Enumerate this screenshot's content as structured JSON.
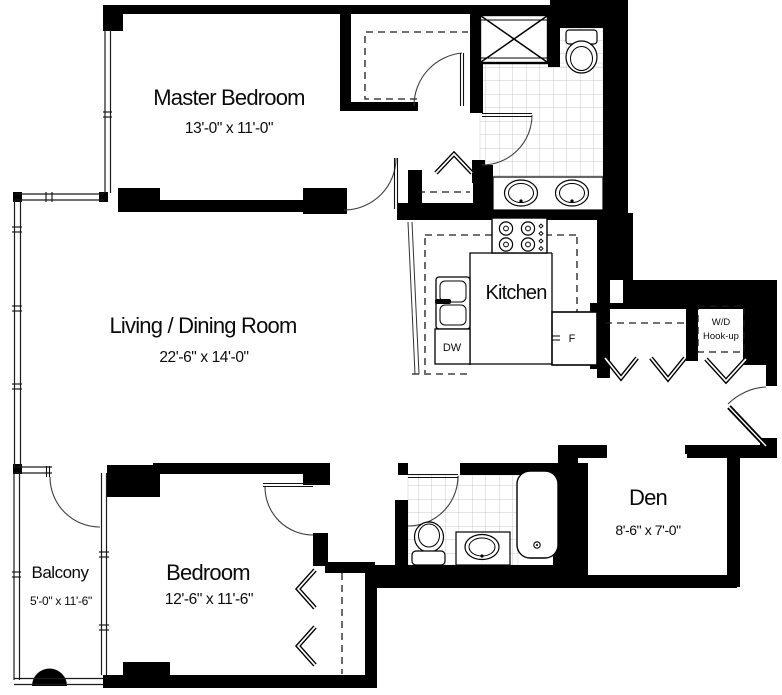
{
  "plan": {
    "rooms": [
      {
        "id": "master-bedroom",
        "label": "Master Bedroom",
        "dims": "13'-0\" x 11'-0\""
      },
      {
        "id": "living-dining",
        "label": "Living / Dining Room",
        "dims": "22'-6\" x 14'-0\""
      },
      {
        "id": "kitchen",
        "label": "Kitchen",
        "dims": ""
      },
      {
        "id": "den",
        "label": "Den",
        "dims": "8'-6\" x 7'-0\""
      },
      {
        "id": "bedroom",
        "label": "Bedroom",
        "dims": "12'-6\" x 11'-6\""
      },
      {
        "id": "balcony",
        "label": "Balcony",
        "dims": "5'-0\" x 11'-6\""
      }
    ],
    "appliances": {
      "dishwasher": "DW",
      "refrigerator": "F"
    },
    "laundry": {
      "line1": "W/D",
      "line2": "Hook-up"
    },
    "colors": {
      "wall": "#000000",
      "floor": "#ffffff",
      "tile_grid": "#c9c9c9",
      "line": "#1a1a1a"
    }
  }
}
